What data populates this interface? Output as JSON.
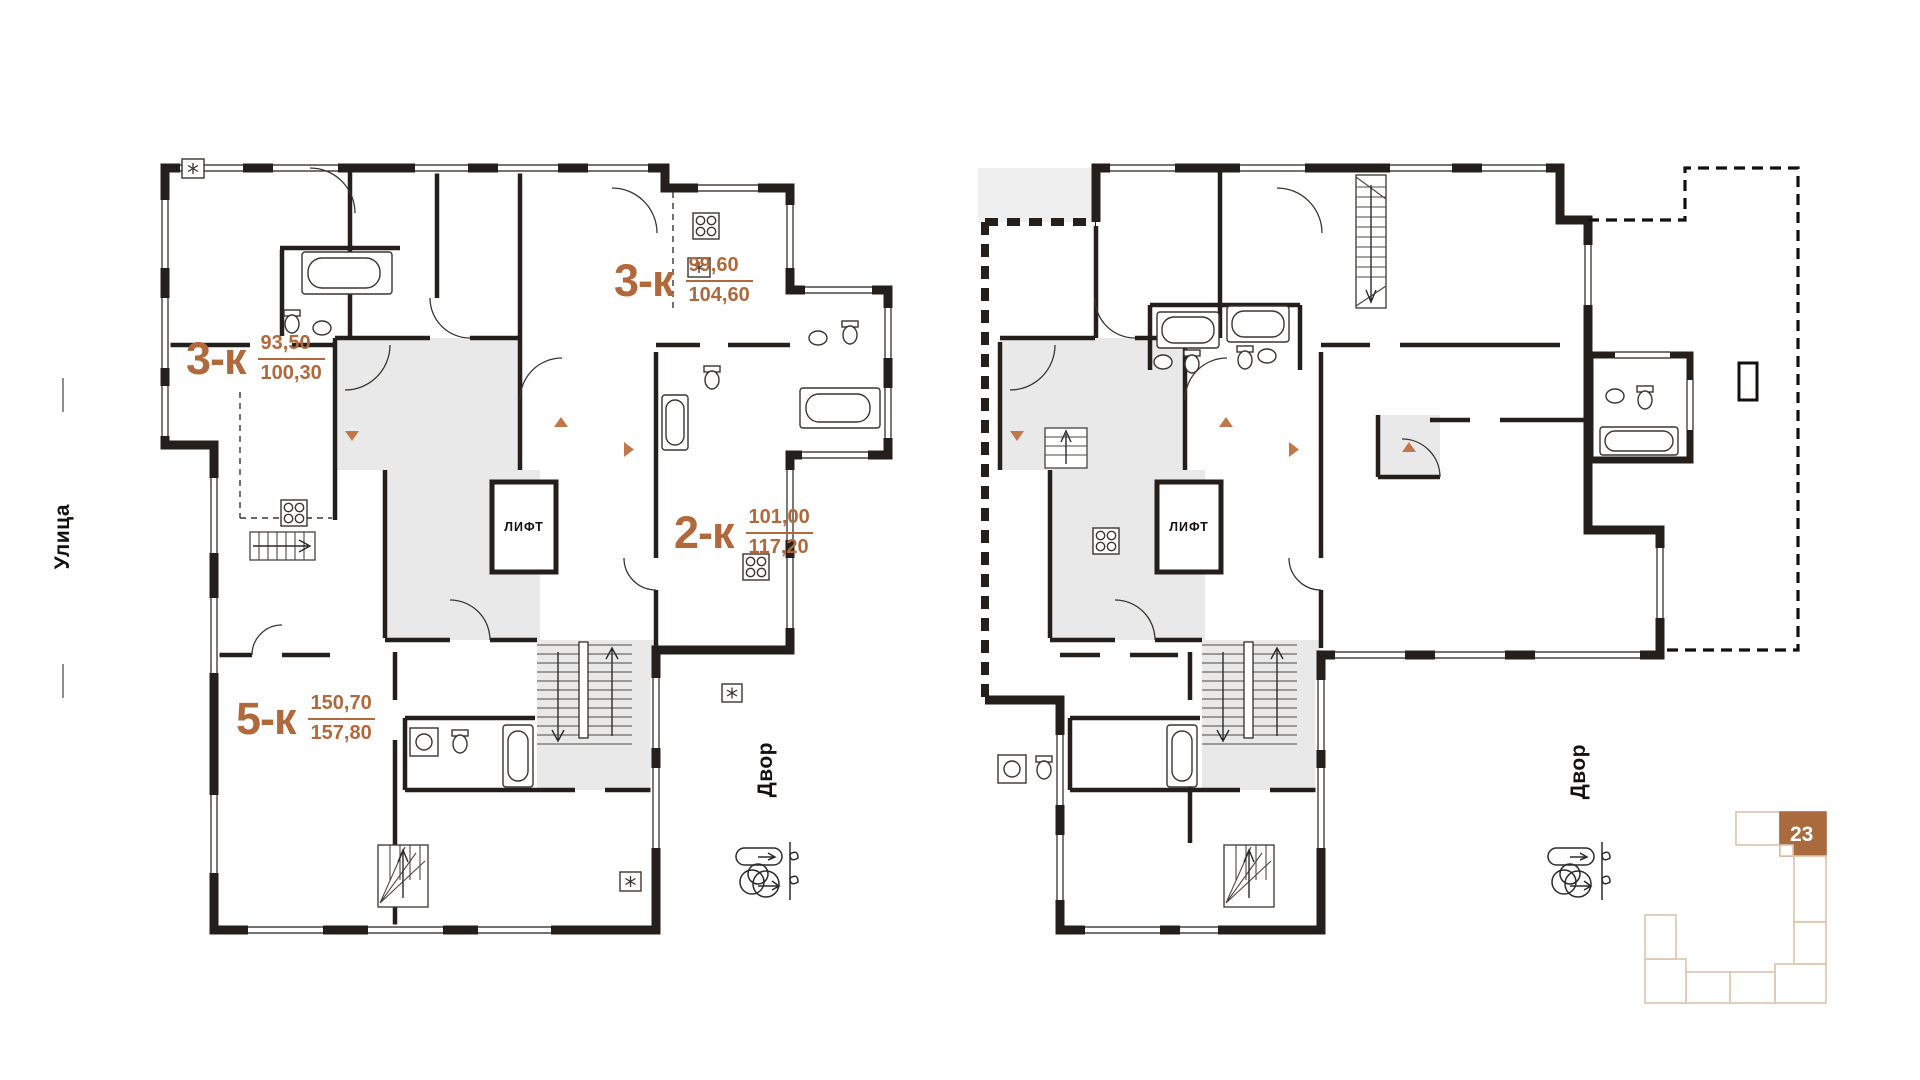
{
  "page": {
    "background": "#ffffff"
  },
  "colors": {
    "accent_text": "#b1693c",
    "entrance_marker": "#c0784a",
    "wall": "#241f1a",
    "core_fill": "#e9e9e9",
    "neighbor_fill": "#efefef",
    "minimap_outline": "#e0c1a8",
    "minimap_active_fill": "#a96a3e",
    "minimap_active_text": "#ffffff"
  },
  "street_label": "Улица",
  "plans": {
    "left": {
      "apartments": [
        {
          "type": "3-к",
          "area_living": "93,50",
          "area_total": "100,30"
        },
        {
          "type": "3-к",
          "area_living": "99,60",
          "area_total": "104,60"
        },
        {
          "type": "2-к",
          "area_living": "101,00",
          "area_total": "117,20"
        },
        {
          "type": "5-к",
          "area_living": "150,70",
          "area_total": "157,80"
        }
      ],
      "elevator_label": "ЛИФТ",
      "courtyard_label": "Двор"
    },
    "right": {
      "elevator_label": "ЛИФТ",
      "courtyard_label": "Двор"
    }
  },
  "minimap": {
    "active_section": "23"
  }
}
